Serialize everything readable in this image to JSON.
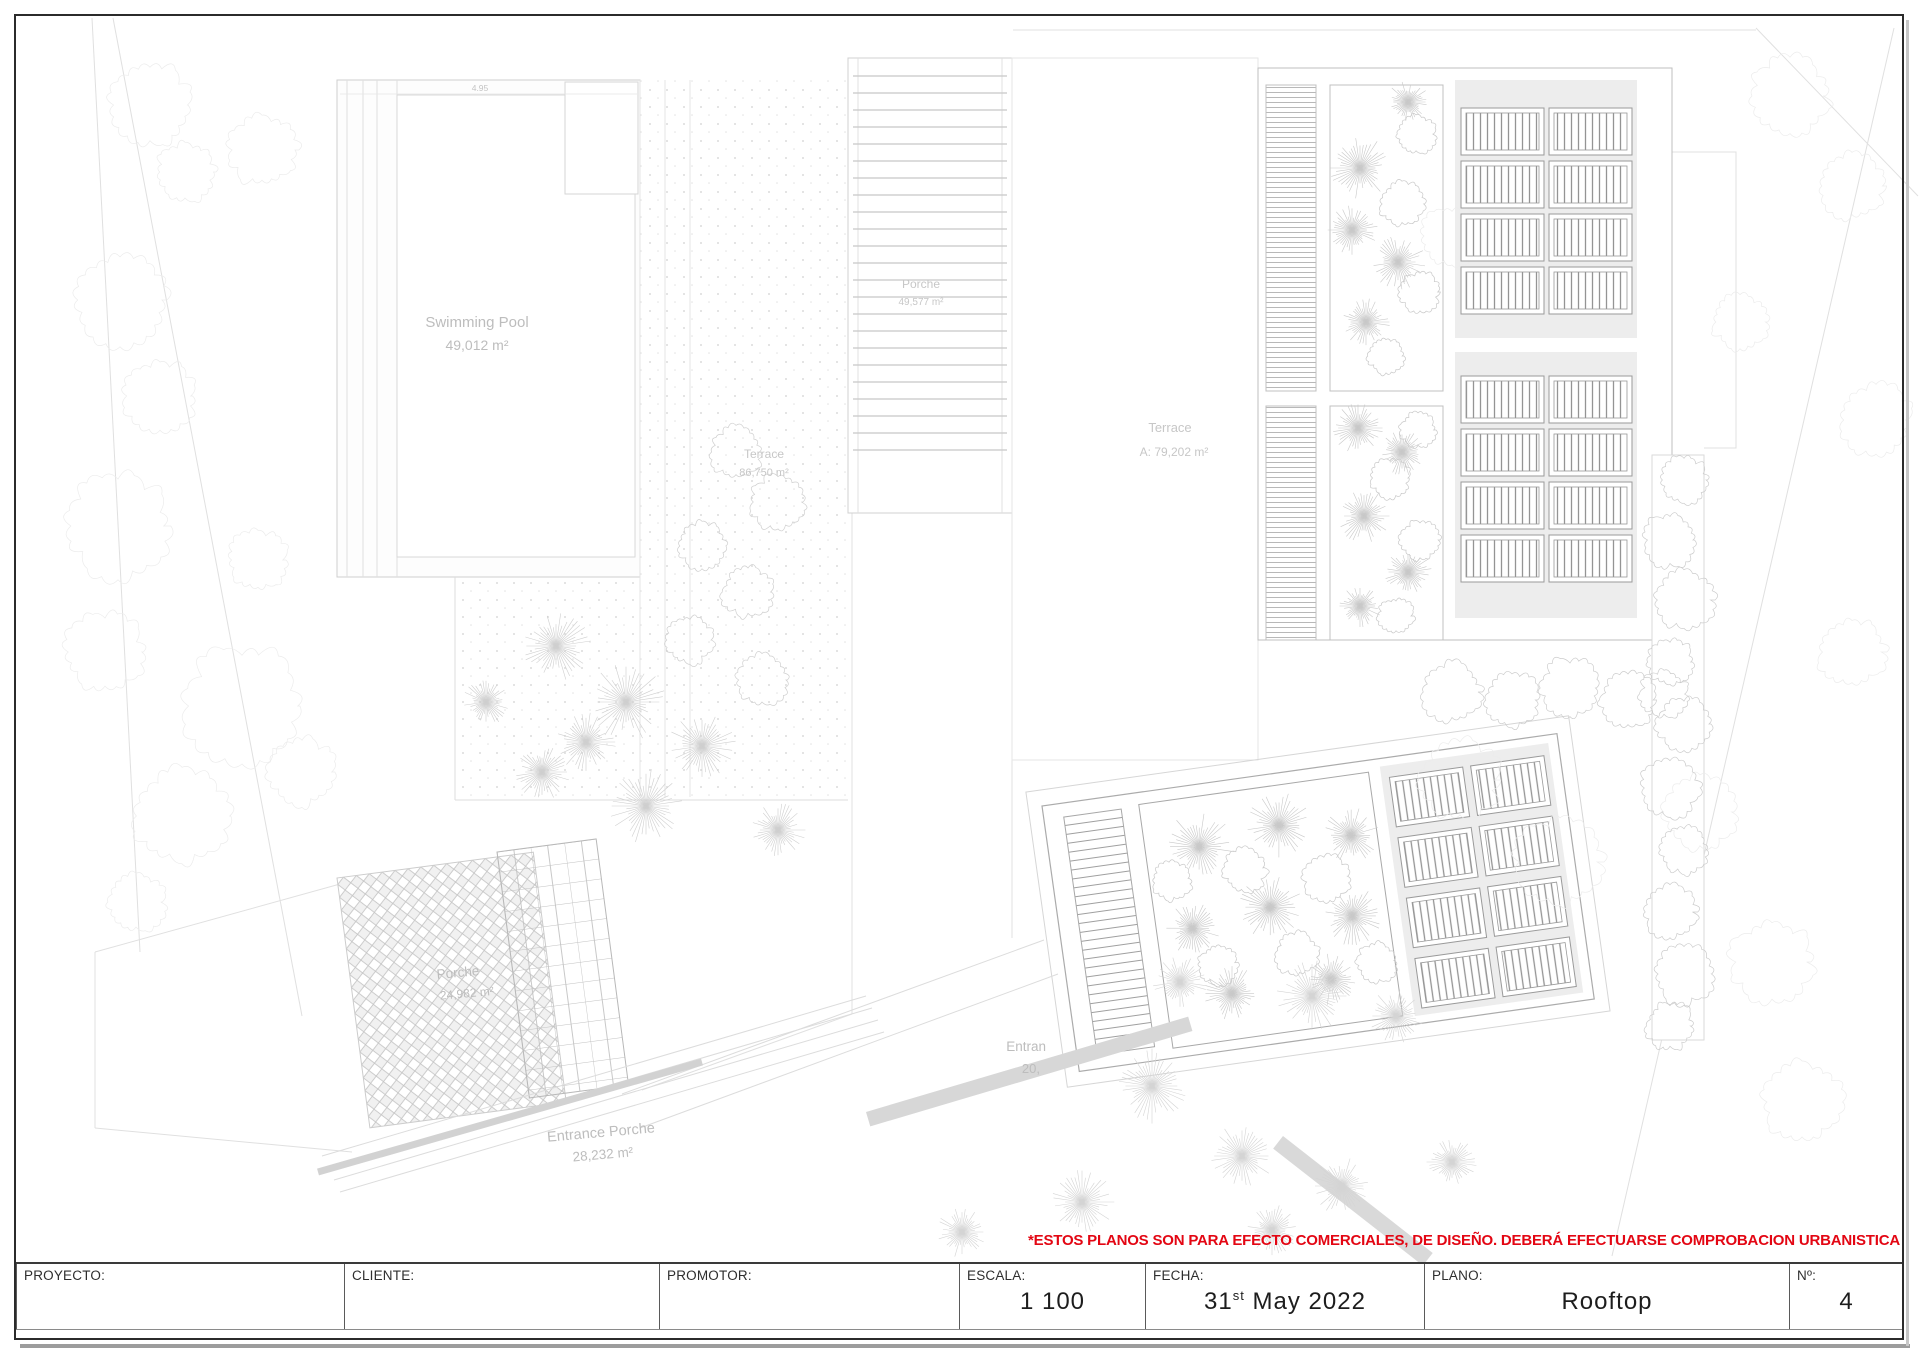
{
  "sheet": {
    "disclaimer": "*ESTOS PLANOS SON PARA EFECTO COMERCIALES, DE DISEÑO. DEBERÁ EFECTUARSE COMPROBACION URBANISTICA",
    "disclaimer_color": "#e30613"
  },
  "title_block": {
    "proyecto_label": "PROYECTO:",
    "cliente_label": "CLIENTE:",
    "promotor_label": "PROMOTOR:",
    "escala_label": "ESCALA:",
    "escala_value": "1 100",
    "fecha_label": "FECHA:",
    "fecha_day": "31",
    "fecha_ordinal": "st",
    "fecha_rest": "May 2022",
    "plano_label": "PLANO:",
    "plano_value": "Rooftop",
    "numero_label": "Nº:",
    "numero_value": "4"
  },
  "plan": {
    "swimming_pool": {
      "name": "Swimming Pool",
      "area": "49,012 m²"
    },
    "porche_top": {
      "name": "Porche",
      "area": "49,577 m²"
    },
    "terrace_left": {
      "name": "Terrace",
      "area": "86,750 m²"
    },
    "terrace_right": {
      "name": "Terrace",
      "area": "A: 79,202 m²"
    },
    "porche_bottom": {
      "name": "Porche",
      "area": "24,982 m²"
    },
    "entrance_porche": {
      "name": "Entrance Porche",
      "area": "28,232 m²"
    },
    "entrance_partial": {
      "name": "Entran",
      "area": "20,"
    },
    "pool_dimension": "4.95"
  }
}
